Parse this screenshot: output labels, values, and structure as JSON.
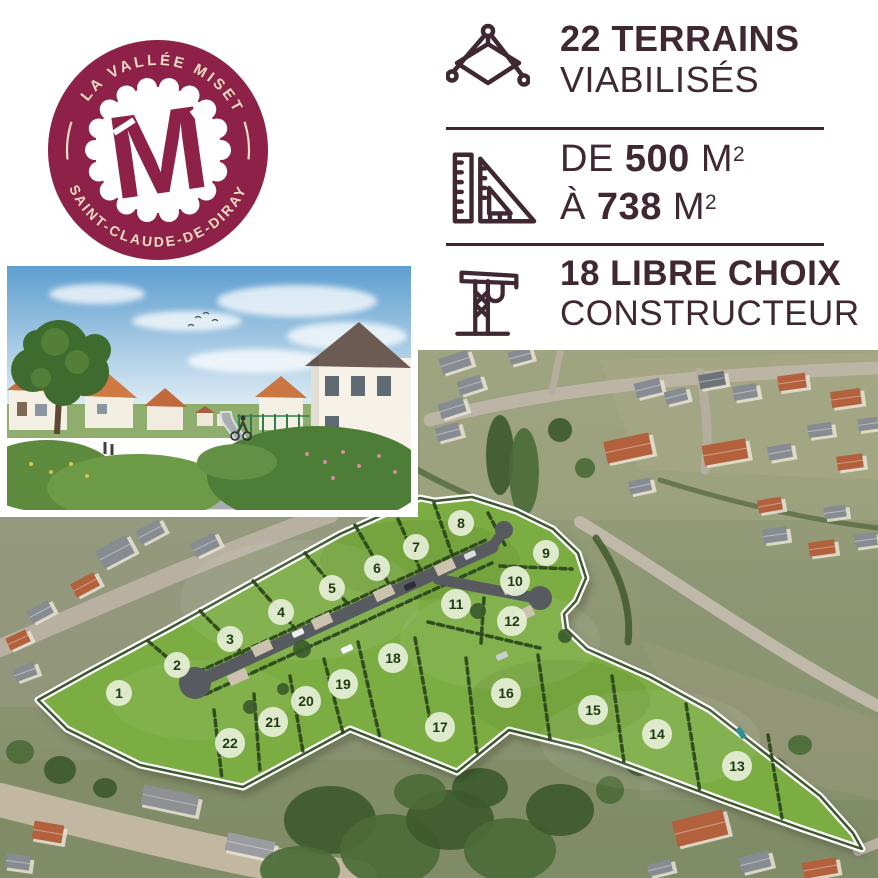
{
  "logo": {
    "arc_top_text": "LA VALLÉE MISET",
    "arc_bottom_text": "SAINT-CLAUDE-DE-DIRAY",
    "monogram": "M",
    "badge_color": "#8e2148",
    "cream_color": "#f0dcc2"
  },
  "info_panel": {
    "text_color": "#3f2832",
    "row1": {
      "line1": "22 TERRAINS",
      "line2": "VIABILISÉS",
      "icon": "survey-plot-icon"
    },
    "row2": {
      "prefix1": "DE",
      "value1": "500",
      "unit1": "M",
      "sup1": "2",
      "prefix2": "À",
      "value2": "738",
      "unit2": "M",
      "sup2": "2",
      "icon": "set-square-icon"
    },
    "row3": {
      "line1": "18 LIBRE CHOIX",
      "line2": "CONSTRUCTEUR",
      "icon": "crane-icon"
    }
  },
  "map": {
    "site_fill_color": "#7cad43",
    "hedge_color": "#2a461b",
    "road_color": "#575b5f",
    "lot_circle_fill": "#e4edd4",
    "lot_number_color": "#1e3a10",
    "outline_color": "#ffffff",
    "lots": [
      {
        "n": "1",
        "x": 119,
        "y": 693
      },
      {
        "n": "2",
        "x": 177,
        "y": 665
      },
      {
        "n": "3",
        "x": 230,
        "y": 639
      },
      {
        "n": "4",
        "x": 281,
        "y": 612
      },
      {
        "n": "5",
        "x": 332,
        "y": 588
      },
      {
        "n": "6",
        "x": 377,
        "y": 568
      },
      {
        "n": "7",
        "x": 416,
        "y": 547
      },
      {
        "n": "8",
        "x": 461,
        "y": 523
      },
      {
        "n": "9",
        "x": 546,
        "y": 553
      },
      {
        "n": "10",
        "x": 515,
        "y": 581
      },
      {
        "n": "11",
        "x": 456,
        "y": 604
      },
      {
        "n": "12",
        "x": 512,
        "y": 621
      },
      {
        "n": "13",
        "x": 737,
        "y": 766
      },
      {
        "n": "14",
        "x": 657,
        "y": 734
      },
      {
        "n": "15",
        "x": 593,
        "y": 710
      },
      {
        "n": "16",
        "x": 506,
        "y": 693
      },
      {
        "n": "17",
        "x": 440,
        "y": 727
      },
      {
        "n": "18",
        "x": 393,
        "y": 658
      },
      {
        "n": "19",
        "x": 343,
        "y": 684
      },
      {
        "n": "20",
        "x": 306,
        "y": 701
      },
      {
        "n": "21",
        "x": 273,
        "y": 722
      },
      {
        "n": "22",
        "x": 230,
        "y": 743
      }
    ]
  }
}
